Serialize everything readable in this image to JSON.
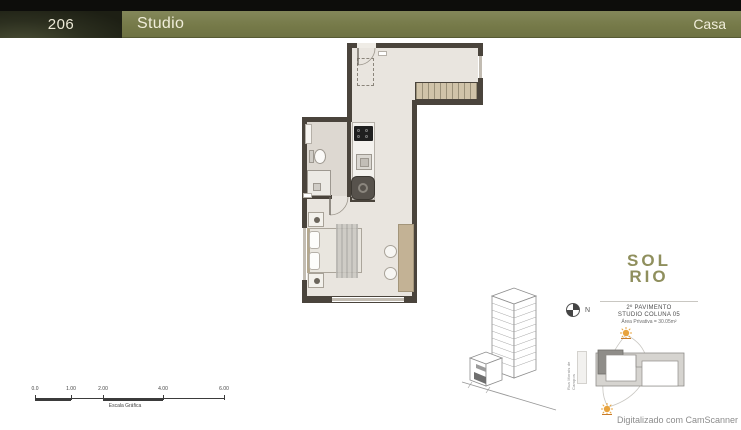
{
  "header": {
    "unit_number": "206",
    "title": "Studio",
    "right_label": "Casa"
  },
  "scale_bar": {
    "ticks": [
      "0.0",
      "1.00",
      "2.00",
      "4.00",
      "6.00"
    ],
    "caption": "Escala Gráfica"
  },
  "compass": {
    "label": "N"
  },
  "site": {
    "street_label": "Rua Morais de Campos"
  },
  "logo": {
    "line1": "SOL",
    "line2": "RIO"
  },
  "unit_info": {
    "pavimento": "2º PAVIMENTO",
    "coluna": "STUDIO COLUNA 05",
    "area": "Área Privativa = 30.05m²"
  },
  "watermark": {
    "text": "Digitalizado com CamScanner"
  },
  "colors": {
    "header_olive": "#767a49",
    "header_dark": "#24271a",
    "wall": "#4a443c",
    "floor": "#e9e5df",
    "stair_tan": "#d0c3a9",
    "furniture_tan": "#c3b295",
    "sun_orange": "#e8a33d",
    "logo_olive": "#8f8f5d"
  }
}
